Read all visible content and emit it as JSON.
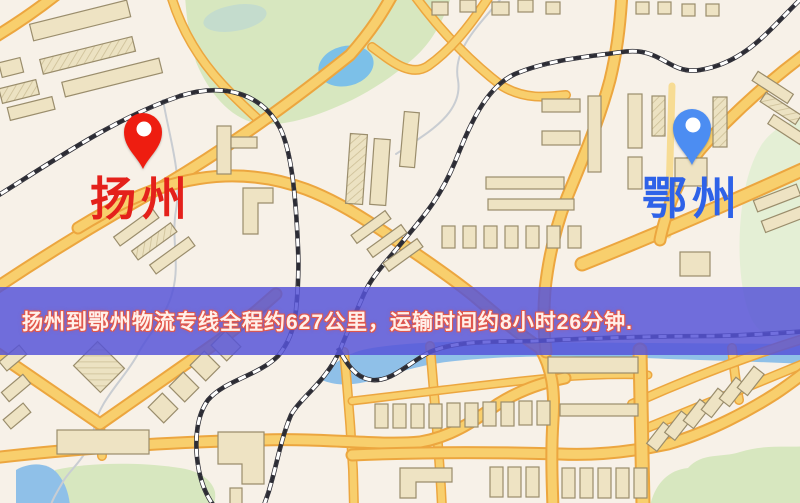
{
  "banner": {
    "text": "扬州到鄂州物流专线全程约627公里，运输时间约8小时26分钟."
  },
  "markers": {
    "origin": {
      "name": "扬州",
      "pin": "red-pin",
      "pin_color": "#ee1d10",
      "label_color": "#e4211b"
    },
    "destination": {
      "name": "鄂州",
      "pin": "blue-pin",
      "pin_color": "#4c8df2",
      "label_color": "#2e62e8"
    }
  },
  "theme": {
    "bannerBg": "rgba(86,84,216,0.84)",
    "bannerText": "#fff0ea",
    "bannerOutline": "#e2574a",
    "pinRed": "#ee1d10",
    "pinBlue": "#4c8df2",
    "labelRed": "#e4211b",
    "labelBlue": "#2e62e8",
    "road": "#f8cf6d",
    "roadEdge": "#eca63f",
    "roadPale": "#f7dc94",
    "rail": "#2c2c34",
    "building": "#eee3c3",
    "buildingEdge": "#9a8d6c",
    "green": "#d7e7bf",
    "greenPale": "#e4efd5",
    "water": "#8fc0e8",
    "waterDeep": "#7cc0e8"
  }
}
